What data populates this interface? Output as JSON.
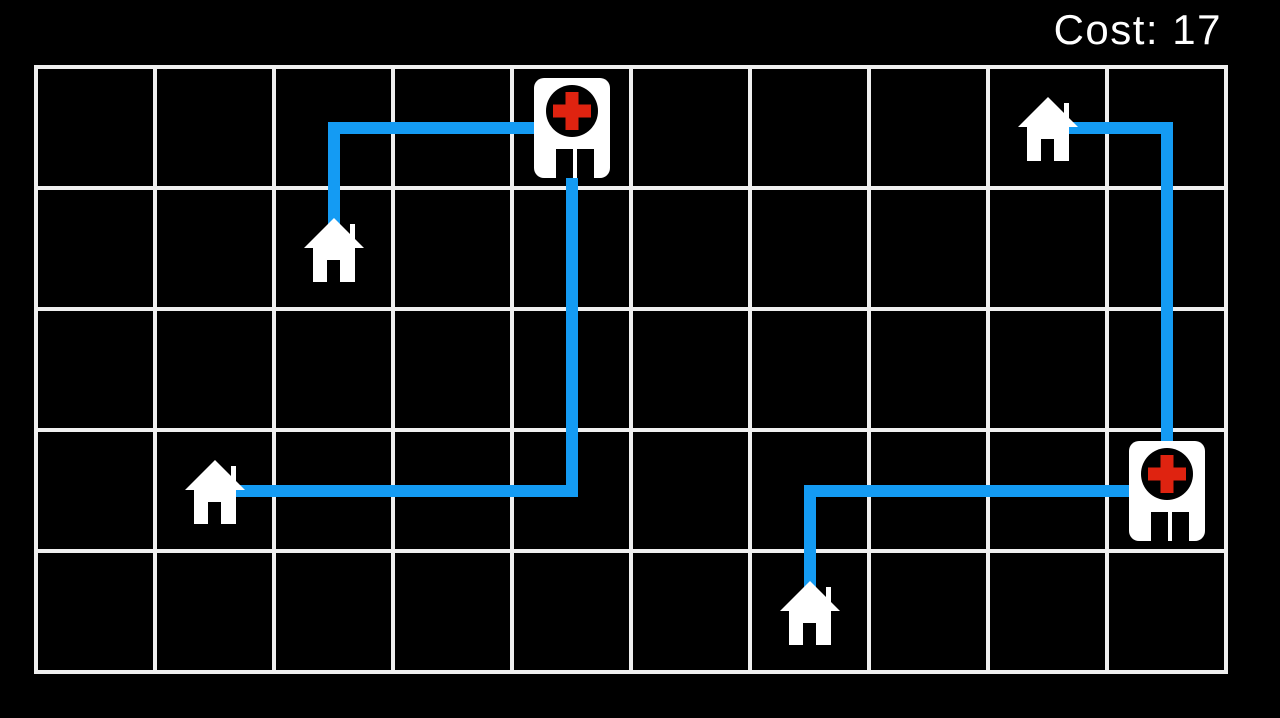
{
  "hud": {
    "cost_label": "Cost: 17",
    "cost_value": 17
  },
  "board": {
    "cols": 10,
    "rows": 5,
    "colors": {
      "background": "#000000",
      "grid_line": "#efefef",
      "path": "#149BF3",
      "building_fill": "#ffffff",
      "hospital_circle": "#000000",
      "hospital_cross": "#DF2310",
      "door": "#000000"
    },
    "buildings": [
      {
        "type": "hospital",
        "col": 4,
        "row": 0
      },
      {
        "type": "hospital",
        "col": 9,
        "row": 3
      },
      {
        "type": "house",
        "col": 2,
        "row": 1
      },
      {
        "type": "house",
        "col": 1,
        "row": 3
      },
      {
        "type": "house",
        "col": 8,
        "row": 0
      },
      {
        "type": "house",
        "col": 6,
        "row": 4
      }
    ],
    "paths": [
      {
        "name": "hospital-top-to-house-upper-left",
        "points": [
          [
            4,
            0
          ],
          [
            2,
            0
          ],
          [
            2,
            1
          ]
        ],
        "length": 3
      },
      {
        "name": "hospital-top-to-house-left",
        "points": [
          [
            4,
            0
          ],
          [
            4,
            3
          ],
          [
            1,
            3
          ]
        ],
        "length": 6
      },
      {
        "name": "house-bottom-to-hospital-right",
        "points": [
          [
            6,
            4
          ],
          [
            6,
            3
          ],
          [
            9,
            3
          ]
        ],
        "length": 4
      },
      {
        "name": "house-upper-right-to-hospital-right",
        "points": [
          [
            8,
            0
          ],
          [
            9,
            0
          ],
          [
            9,
            3
          ]
        ],
        "length": 4
      }
    ]
  }
}
